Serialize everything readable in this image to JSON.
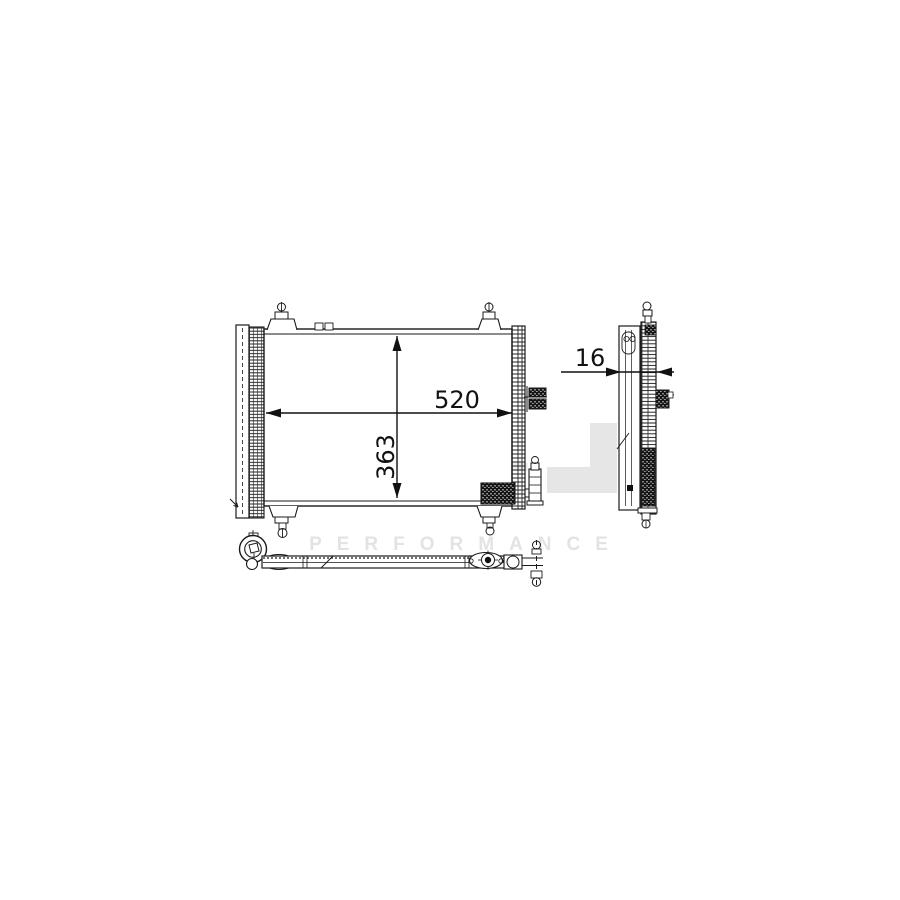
{
  "dimensions": {
    "width": "520",
    "height": "363",
    "depth": "16"
  },
  "watermark": {
    "letter": "M",
    "ghost_letters": "AHL",
    "subtitle": "PERFORMANCE",
    "gray": "#e8e8e8",
    "band_gray": "#e6e6e6",
    "accent_color": "#f1ebd2",
    "subtitle_color": "#e3e3e3"
  },
  "colors": {
    "line": "#1a1a1a",
    "background": "#ffffff"
  }
}
